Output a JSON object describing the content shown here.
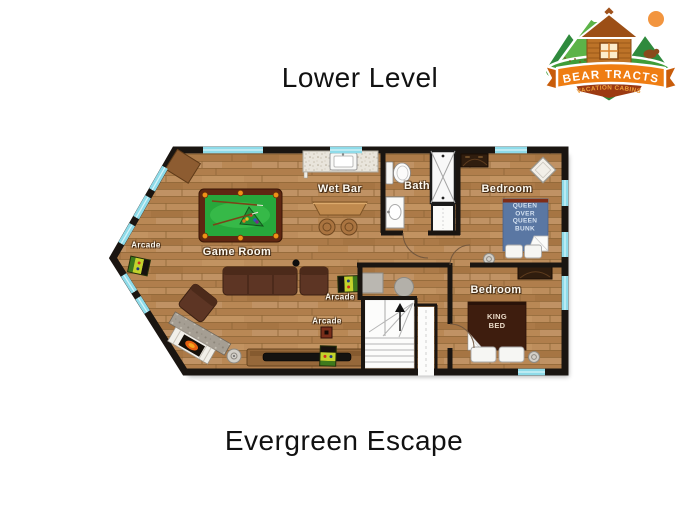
{
  "titles": {
    "level": "Lower Level",
    "property": "Evergreen Escape"
  },
  "logo": {
    "name": "BEAR TRACTS",
    "tagline": "VACATION CABINS"
  },
  "plan": {
    "rooms": [
      {
        "label": "Game Room"
      },
      {
        "label": "Wet Bar"
      },
      {
        "label": "Bath"
      },
      {
        "label": "Bedroom"
      },
      {
        "label": "Bedroom"
      }
    ],
    "arcades": [
      {
        "label": "Arcade"
      },
      {
        "label": "Arcade"
      },
      {
        "label": "Arcade"
      }
    ],
    "beds": [
      {
        "label": "QUEEN OVER QUEEN BUNK"
      },
      {
        "label": "KING BED"
      }
    ],
    "colors": {
      "floor_wood": "#b8865a",
      "walls": "#1a1511",
      "windows": "#8edbe9",
      "pool_felt": "#2eb34a",
      "bunk_bed": "#5a77a3",
      "king_bed": "#3e1d0e",
      "sofa": "#5d3524",
      "logo_orange": "#ef7d12",
      "logo_green": "#2f8a3d"
    }
  }
}
